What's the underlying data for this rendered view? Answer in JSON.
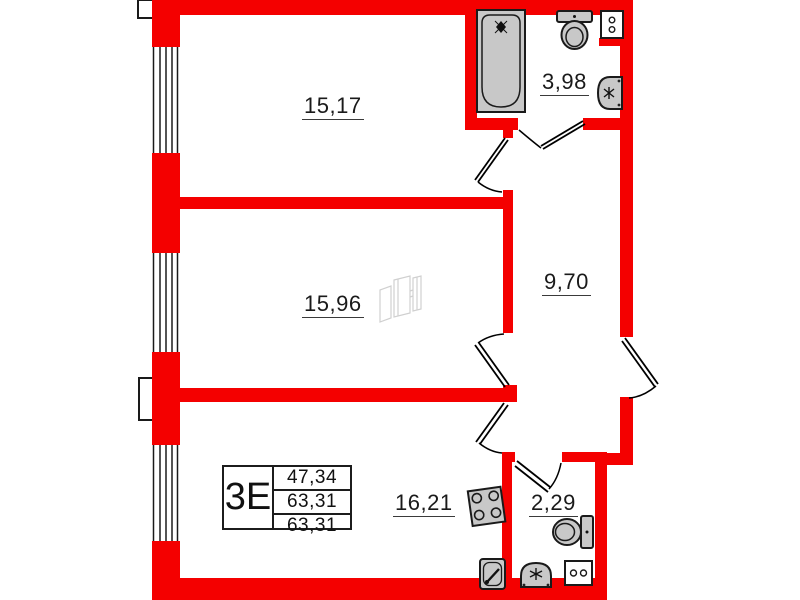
{
  "title": "apartment-floor-plan",
  "unit": {
    "type_label": "3Е",
    "table_rows": [
      "47,34",
      "63,31",
      "63,31"
    ]
  },
  "rooms": {
    "room_top": {
      "name": "room-top",
      "area": "15,17"
    },
    "room_middle": {
      "name": "room-middle",
      "area": "15,96"
    },
    "hallway": {
      "name": "hallway",
      "area": "9,70"
    },
    "bathroom": {
      "name": "bathroom",
      "area": "3,98"
    },
    "kitchen": {
      "name": "kitchen",
      "area": "16,21"
    },
    "wc": {
      "name": "wc",
      "area": "2,29"
    }
  },
  "icons": {
    "bathtub": "bathtub-icon",
    "toilet_top": "toilet-icon",
    "vent_shaft": "vent-shaft-icon",
    "bathroom_sink": "sink-icon",
    "stove": "stove-icon",
    "kitchen_sink": "kitchen-sink-icon",
    "wc_sink": "wc-sink-icon",
    "wc_toilet": "toilet-icon",
    "washing_machine": "washing-machine-icon",
    "watermark": "developer-logo-watermark"
  },
  "colors": {
    "wall": "#f40000",
    "fixture_fill": "#c8c8c8",
    "outline": "#1a1a1a",
    "watermark": "#d0d0d0"
  }
}
